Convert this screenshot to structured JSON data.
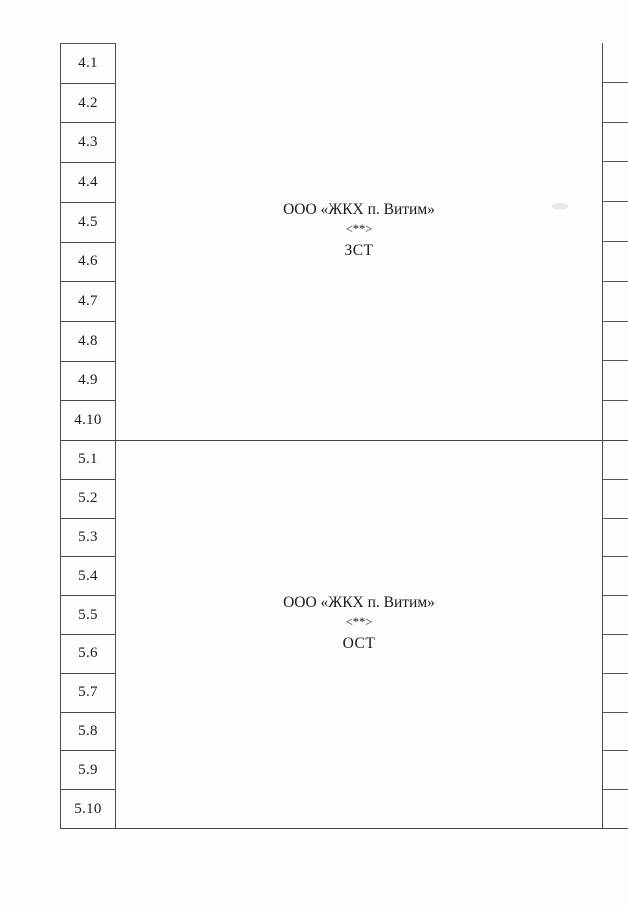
{
  "page": {
    "background": "#fdfdfc",
    "line_color": "#4a4a4a",
    "text_color": "#1a1a1a"
  },
  "table": {
    "sections": [
      {
        "id": "4",
        "rows": [
          "4.1",
          "4.2",
          "4.3",
          "4.4",
          "4.5",
          "4.6",
          "4.7",
          "4.8",
          "4.9",
          "4.10"
        ],
        "cell": {
          "organization": "ООО «ЖКХ п. Витим»",
          "footnote_marker": "<**>",
          "code": "ЗСТ"
        }
      },
      {
        "id": "5",
        "rows": [
          "5.1",
          "5.2",
          "5.3",
          "5.4",
          "5.5",
          "5.6",
          "5.7",
          "5.8",
          "5.9",
          "5.10"
        ],
        "cell": {
          "organization": "ООО «ЖКХ п. Витим»",
          "footnote_marker": "<**>",
          "code": "ОСТ"
        }
      }
    ]
  }
}
